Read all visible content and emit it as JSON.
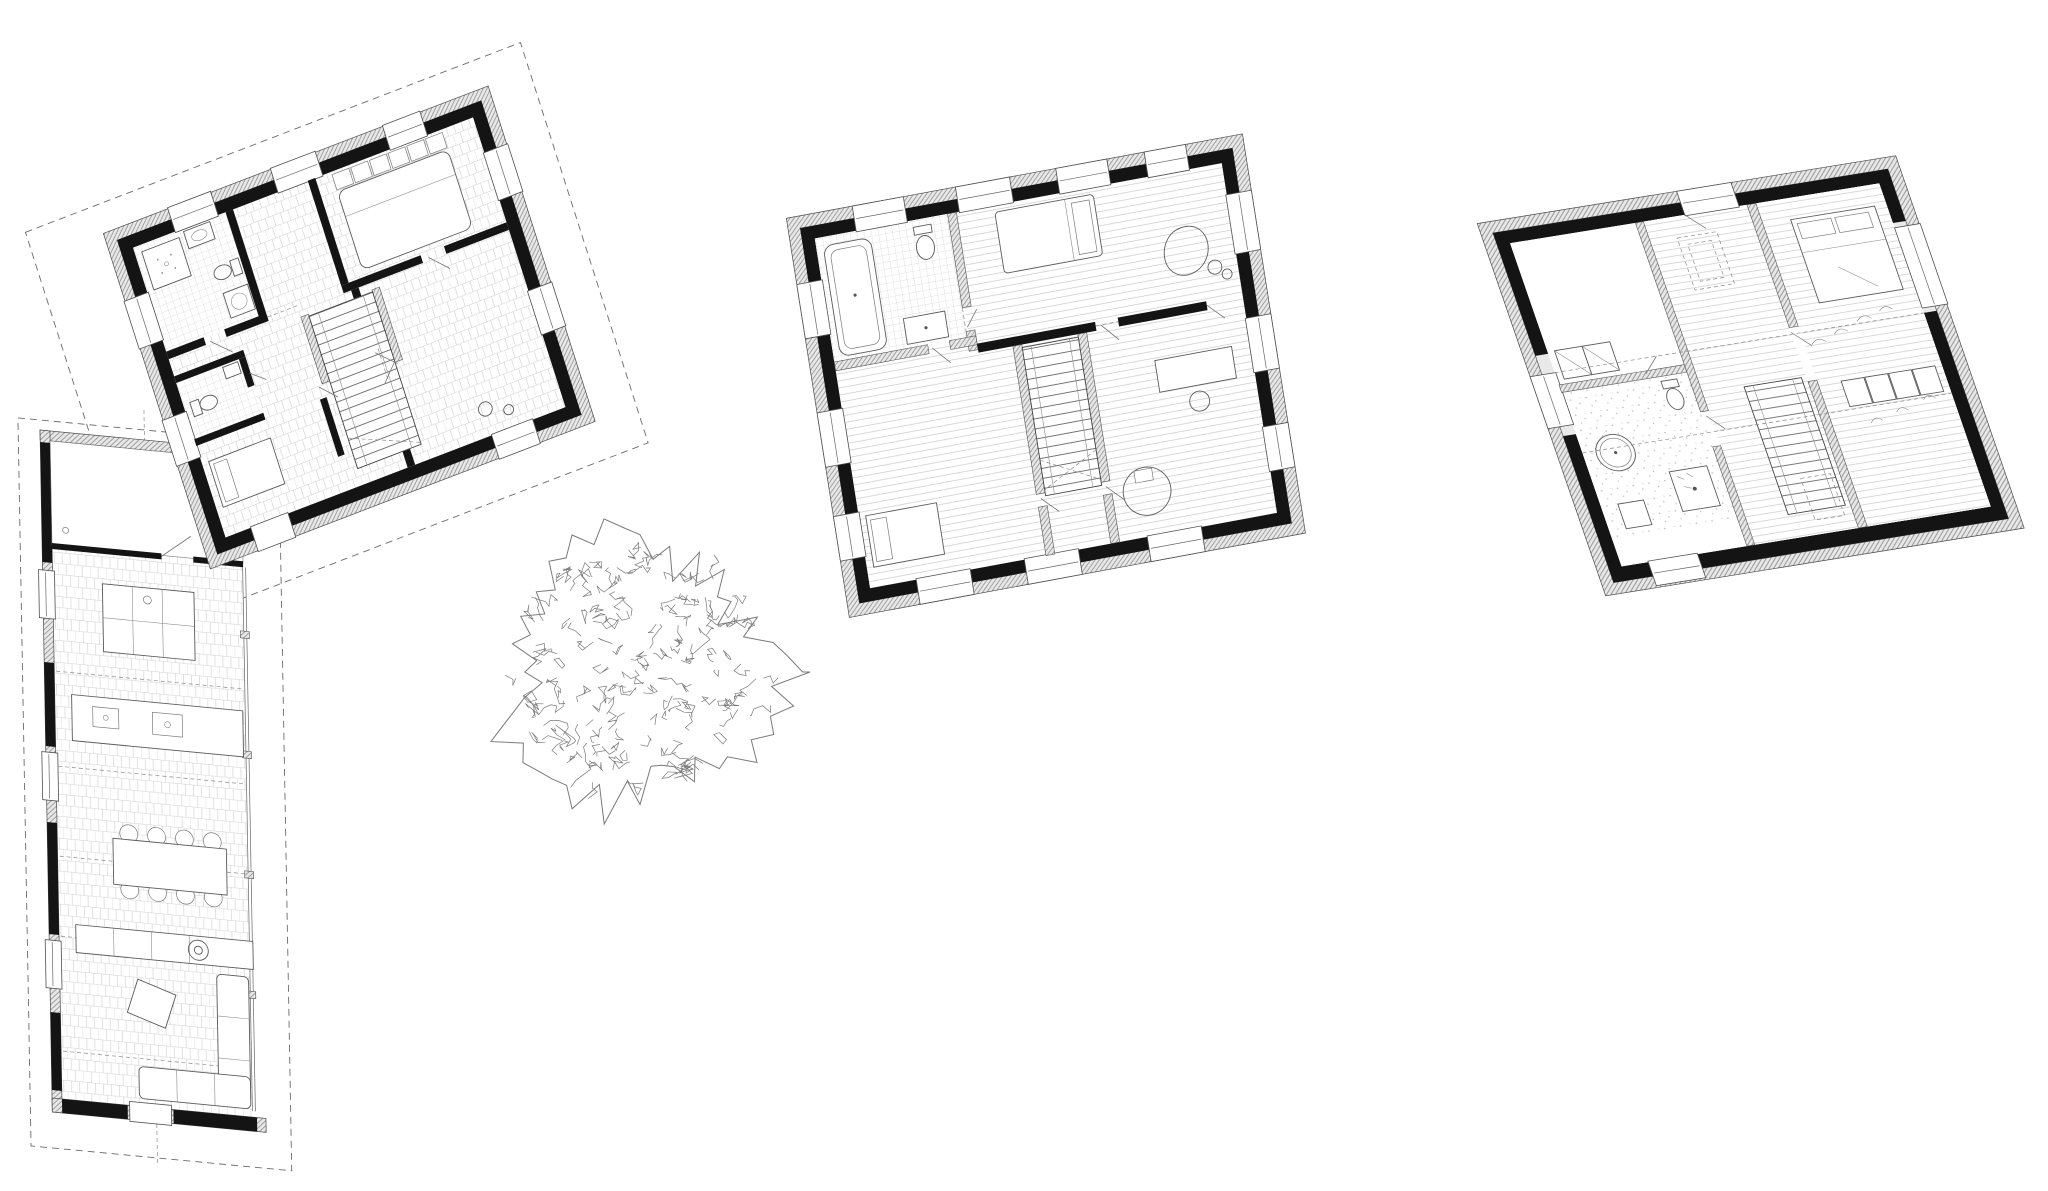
{
  "canvas": {
    "width": 2048,
    "height": 1191,
    "background": "#ffffff"
  },
  "palette": {
    "ink": "#222222",
    "wall_cut": "#141414",
    "insulation_hatch": "#8f8f8f",
    "floor_hatch": "#c9c9c9",
    "furniture_line": "#5a5a5a",
    "dashed_line": "#6a6a6a",
    "tree_line": "#7a7a7a"
  },
  "figures": [
    {
      "name": "ground-floor-plan",
      "kind": "floor-plan",
      "elements": [
        "dashed-roof-outline",
        "exterior-walls",
        "windows",
        "bathroom-shower",
        "wc",
        "bedroom-bed",
        "staircase",
        "kitchen-island",
        "kitchen-counter-two-sinks",
        "dining-table",
        "wood-stove",
        "sofas",
        "glass-wall"
      ]
    },
    {
      "name": "first-floor-plan",
      "kind": "floor-plan",
      "elements": [
        "exterior-walls",
        "windows",
        "bathroom-bathtub",
        "wc",
        "sink",
        "bedroom-bed",
        "lounge-chair",
        "staircase",
        "desk",
        "round-pouf"
      ]
    },
    {
      "name": "attic-floor-plan",
      "kind": "floor-plan",
      "elements": [
        "exterior-walls",
        "windows",
        "round-tub",
        "wc",
        "shower",
        "chimney-dashed",
        "staircase",
        "bedroom-bed",
        "wardrobe",
        "roof-slope-dashed-lines"
      ]
    },
    {
      "name": "site-tree",
      "kind": "tree-canopy",
      "elements": [
        "scribbled-canopy-outline",
        "inner-foliage-marks"
      ]
    }
  ],
  "counts": {
    "plans": 3,
    "dining_chairs": 8,
    "kitchen_sinks": 2
  }
}
